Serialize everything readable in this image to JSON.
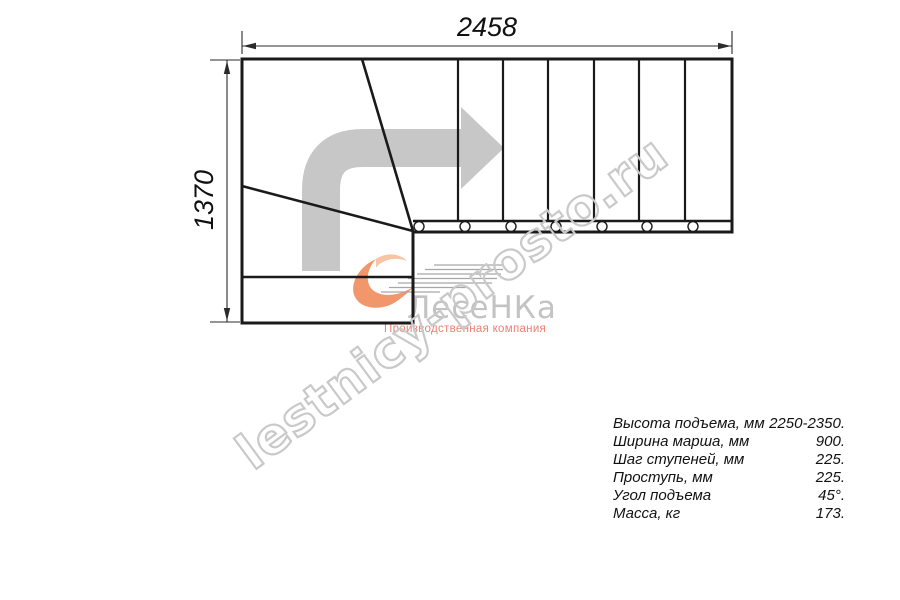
{
  "drawing": {
    "type": "staircase-floor-plan",
    "dimensions": {
      "width_mm": "2458",
      "height_mm": "1370"
    },
    "straight_steps": 7,
    "winder_steps": 3,
    "balusters": 7,
    "turn_direction": "right"
  },
  "watermark": {
    "text": "lestnicy-prosto.ru",
    "color": "#c9c9c9"
  },
  "logo": {
    "name": "ЛесеНКа",
    "tagline": "Производственная компания",
    "swoosh_color": "#f2966b",
    "name_color": "#c3c3c3",
    "tagline_color": "#ee7f72"
  },
  "specs": {
    "rows": [
      {
        "label": "Высота подъема, мм",
        "value": "2250-2350."
      },
      {
        "label": "Ширина марша, мм",
        "value": "900."
      },
      {
        "label": "Шаг ступеней, мм",
        "value": "225."
      },
      {
        "label": "Проступь, мм",
        "value": "225."
      },
      {
        "label": "Угол подъема",
        "value": "45°."
      },
      {
        "label": "Масса, кг",
        "value": "173."
      }
    ]
  },
  "colors": {
    "line": "#1a1a1a",
    "dimension_line": "#2b2b2b",
    "direction_arrow": "#c7c7c7",
    "background": "#ffffff"
  }
}
